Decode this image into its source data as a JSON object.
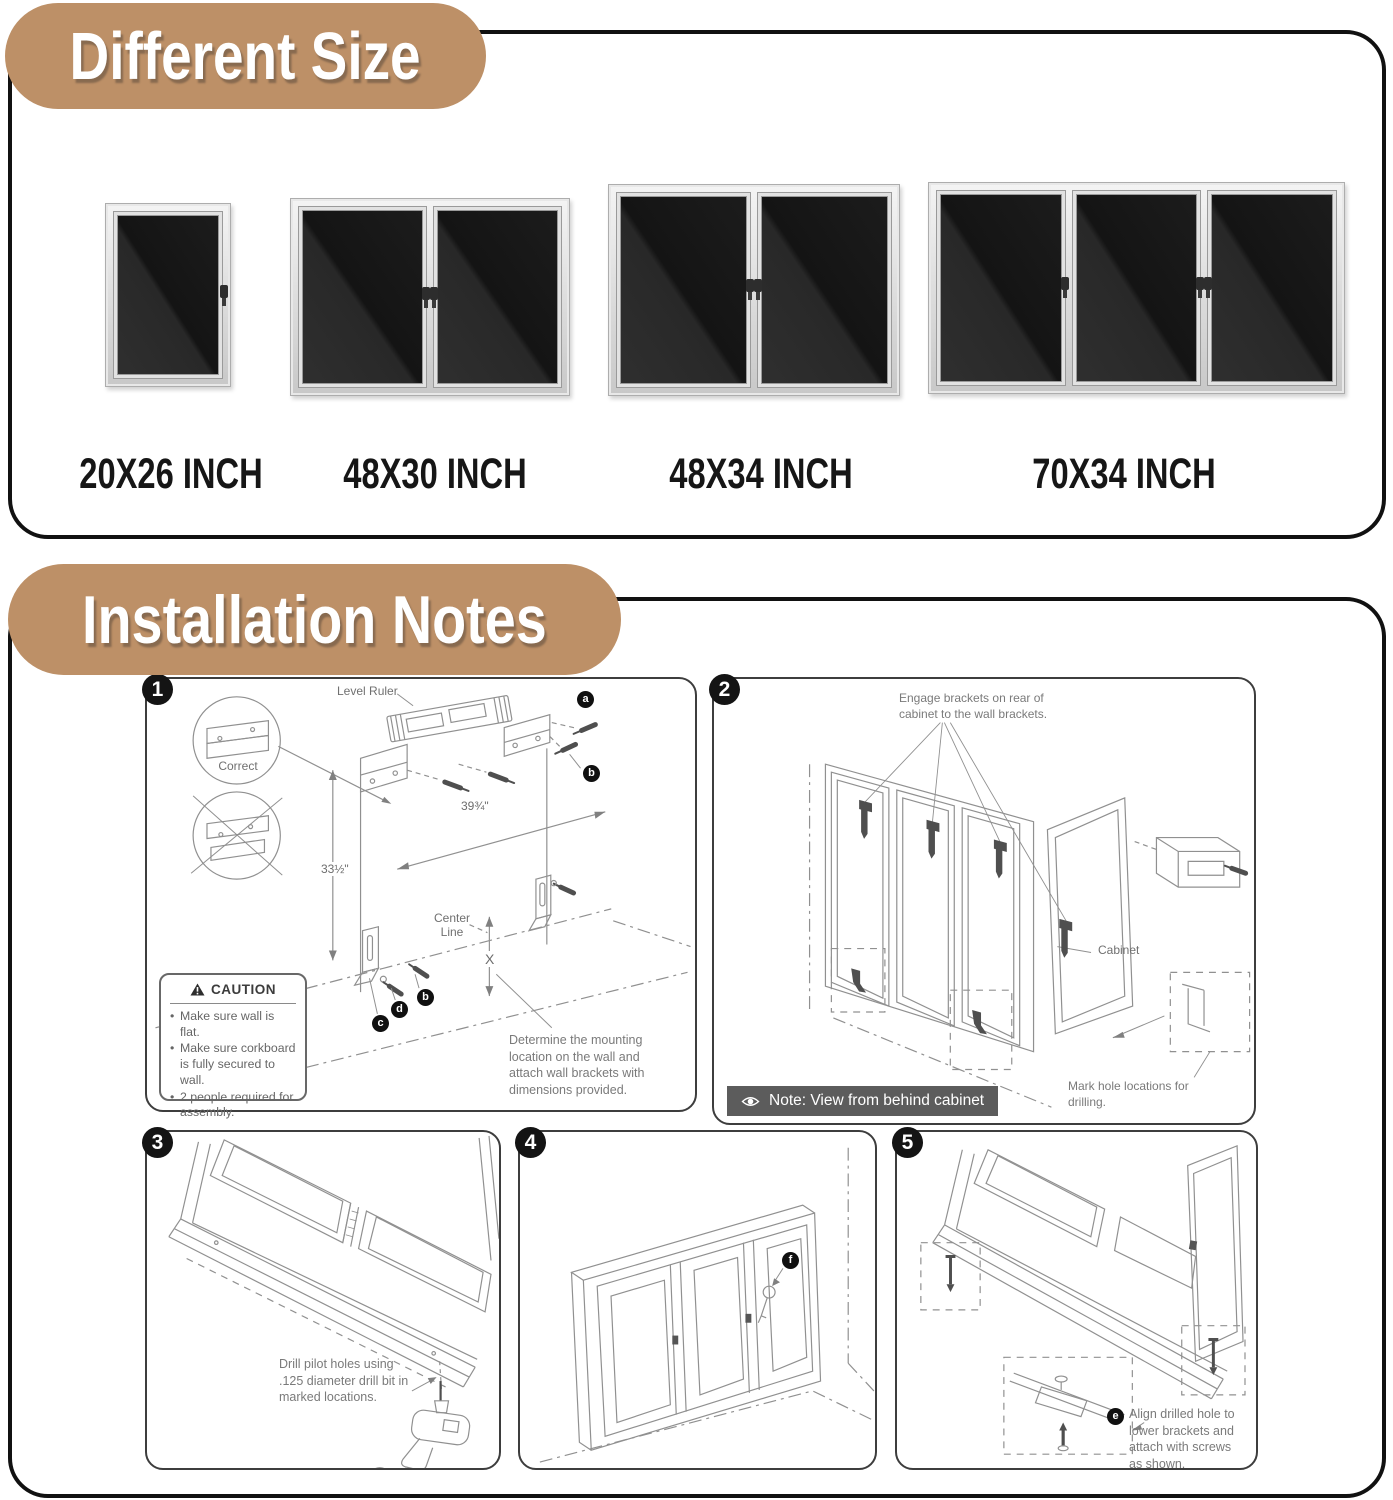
{
  "colors": {
    "badge_bg": "#bd9067",
    "box_border": "#111111",
    "note_bar_bg": "#5c5c5c",
    "line_art": "#909090",
    "board_dark": "#1c1c1c"
  },
  "different_size": {
    "title": "Different Size",
    "boards": [
      {
        "label": "20X26 INCH",
        "doors": 1
      },
      {
        "label": "48X30 INCH",
        "doors": 2
      },
      {
        "label": "48X34 INCH",
        "doors": 2
      },
      {
        "label": "70X34 INCH",
        "doors": 3
      }
    ]
  },
  "installation": {
    "title": "Installation Notes",
    "step1": {
      "number": "1",
      "level_ruler_label": "Level Ruler",
      "correct_label": "Correct",
      "width_dim": "39¾\"",
      "height_dim": "33½\"",
      "center_line_label": "Center Line",
      "x_label": "X",
      "marker_a": "a",
      "marker_b": "b",
      "marker_b2": "b",
      "marker_c": "c",
      "marker_d": "d",
      "caution_title": "CAUTION",
      "caution_items": [
        "Make sure wall is flat.",
        "Make sure corkboard is fully secured to wall.",
        "2 people required for assembly."
      ],
      "description": "Determine the mounting location on the wall and attach wall brackets with dimensions provided."
    },
    "step2": {
      "number": "2",
      "engage_text": "Engage brackets on rear of cabinet to the wall brackets.",
      "cabinet_label": "Cabinet",
      "mark_text": "Mark hole locations for drilling.",
      "note_text": "Note: View from behind cabinet"
    },
    "step3": {
      "number": "3",
      "description": "Drill pilot holes using .125 diameter drill bit in marked locations."
    },
    "step4": {
      "number": "4",
      "marker_f": "f"
    },
    "step5": {
      "number": "5",
      "marker_e": "e",
      "description": "Align drilled hole to lower brackets and attach with screws as shown."
    }
  }
}
